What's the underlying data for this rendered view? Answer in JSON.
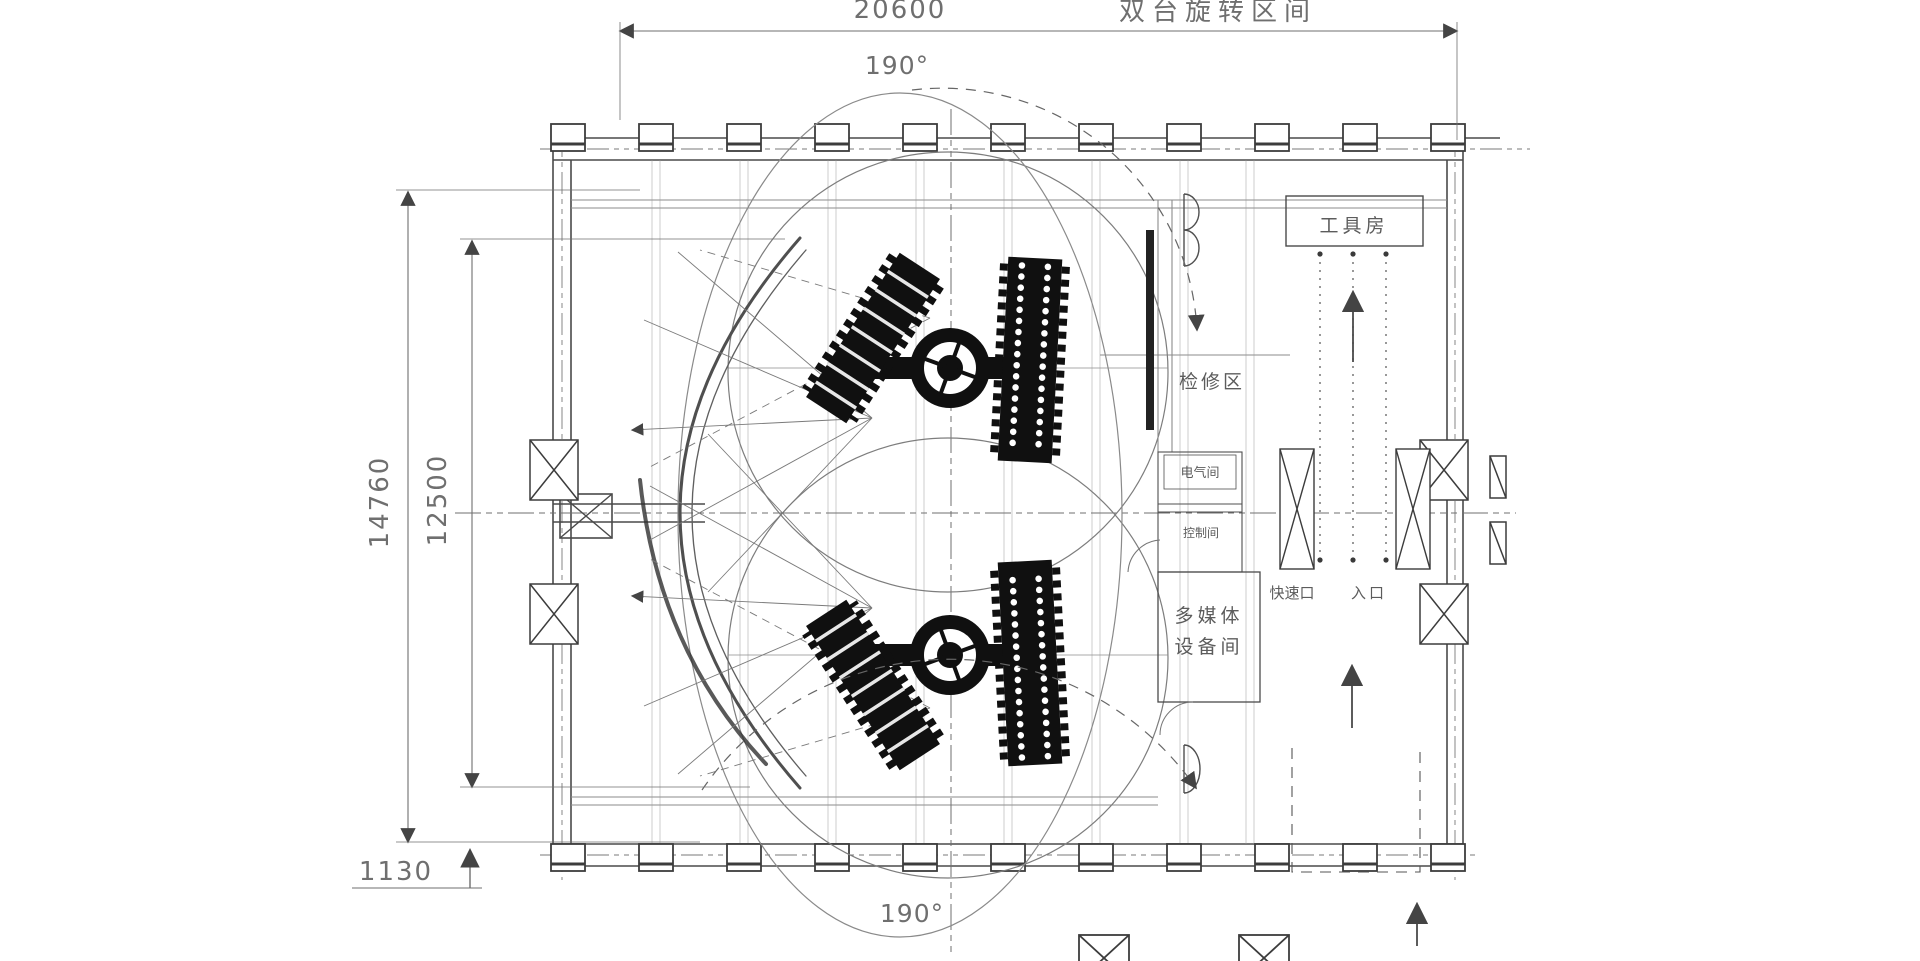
{
  "drawing": {
    "zone_label": "双台旋转区间",
    "dims": {
      "top_width": "20600",
      "height_outer": "14760",
      "height_inner": "12500",
      "offset_bottom": "1130"
    },
    "angles": {
      "top": "190°",
      "bottom": "190°"
    },
    "rooms": {
      "tool_room": "工具房",
      "service_area": "检修区",
      "electrical_room": "电气间",
      "control_room": "控制间",
      "multimedia_line1": "多媒体",
      "multimedia_line2": "设备间",
      "fast_exit": "快速口",
      "entrance": "入口"
    },
    "colors": {
      "line": "#6f6f6f",
      "dark": "#101010",
      "text": "#6f6f6f",
      "background": "#ffffff"
    }
  }
}
